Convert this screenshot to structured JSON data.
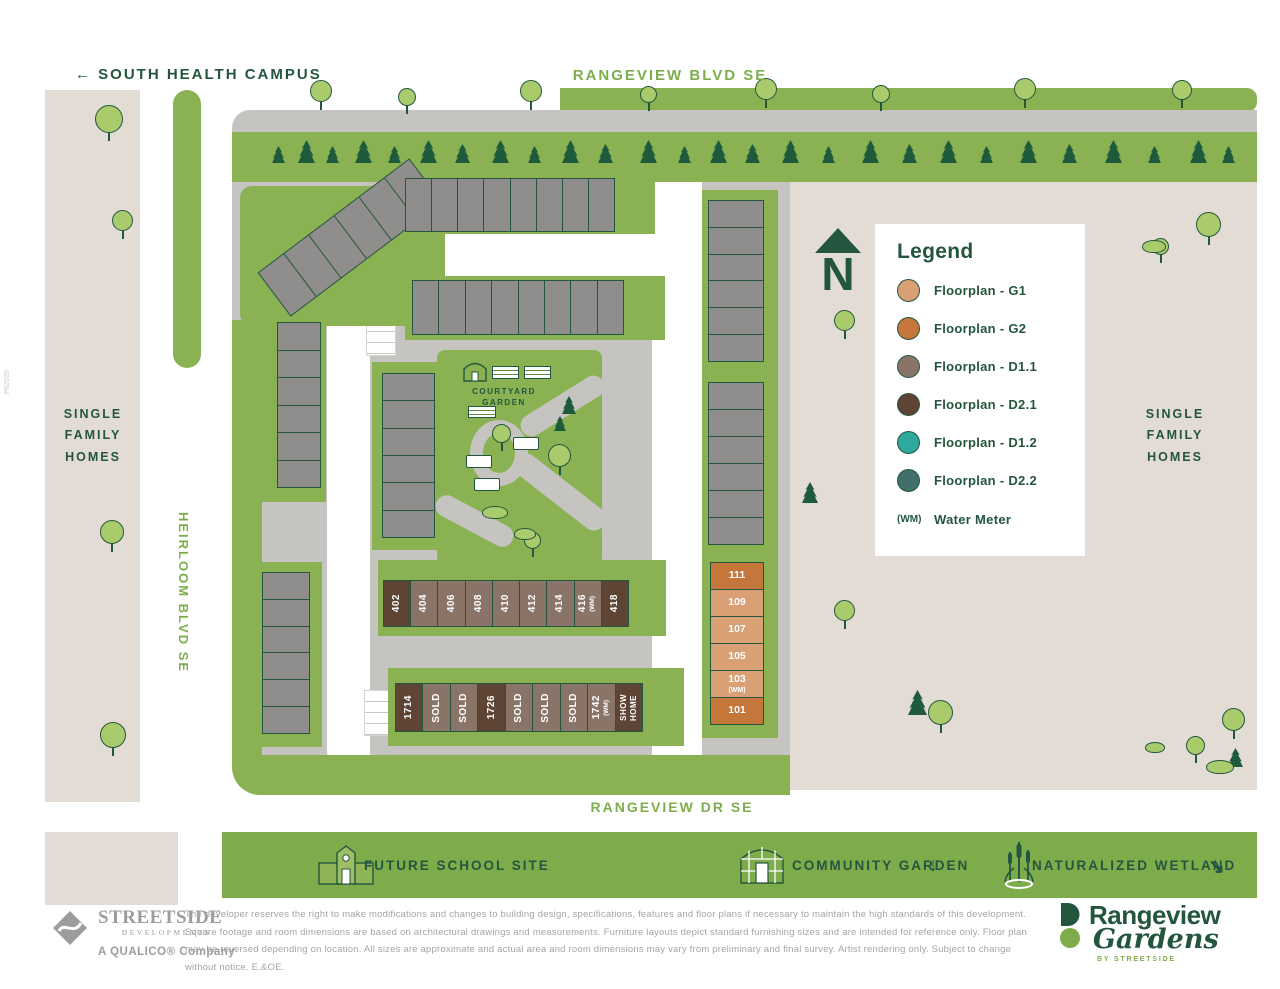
{
  "map": {
    "south_health_campus": "← SOUTH HEALTH CAMPUS",
    "rangeview_blvd": "RANGEVIEW BLVD SE",
    "rangeview_dr": "RANGEVIEW DR SE",
    "heirloom_blvd": "HEIRLOOM BLVD SE",
    "single_family_left": "SINGLE FAMILY HOMES",
    "single_family_right": "SINGLE FAMILY HOMES",
    "north_label": "N",
    "courtyard_line1": "COURTYARD",
    "courtyard_line2": "GARDEN",
    "revision_code": "P62026"
  },
  "legend": {
    "title": "Legend",
    "items": [
      {
        "label": "Floorplan - G1",
        "color": "#D9A075"
      },
      {
        "label": "Floorplan - G2",
        "color": "#C4763B"
      },
      {
        "label": "Floorplan - D1.1",
        "color": "#8A7468"
      },
      {
        "label": "Floorplan - D2.1",
        "color": "#5E4434"
      },
      {
        "label": "Floorplan - D1.2",
        "color": "#2FA89D"
      },
      {
        "label": "Floorplan - D2.2",
        "color": "#41706A"
      }
    ],
    "water_meter_symbol": "(WM)",
    "water_meter_label": "Water Meter"
  },
  "units": {
    "row_400": [
      {
        "label": "402",
        "type": "D2.1"
      },
      {
        "label": "404",
        "type": "D1.1"
      },
      {
        "label": "406",
        "type": "D1.1"
      },
      {
        "label": "408",
        "type": "D1.1"
      },
      {
        "label": "410",
        "type": "D1.1"
      },
      {
        "label": "412",
        "type": "D1.1"
      },
      {
        "label": "414",
        "type": "D1.1"
      },
      {
        "label": "416",
        "sublabel": "(WM)",
        "type": "D1.1"
      },
      {
        "label": "418",
        "type": "D2.1"
      }
    ],
    "row_1700": [
      {
        "label": "1714",
        "type": "D2.1"
      },
      {
        "label": "SOLD",
        "type": "D1.1"
      },
      {
        "label": "SOLD",
        "type": "D1.1"
      },
      {
        "label": "1726",
        "type": "D2.1"
      },
      {
        "label": "SOLD",
        "type": "D1.1"
      },
      {
        "label": "SOLD",
        "type": "D1.1"
      },
      {
        "label": "SOLD",
        "type": "D1.1"
      },
      {
        "label": "1742",
        "sublabel": "(WM)",
        "type": "D1.1"
      },
      {
        "label": "SHOW",
        "label2": "HOME",
        "type": "D2.1"
      }
    ],
    "col_100": [
      {
        "label": "111",
        "type": "G2"
      },
      {
        "label": "109",
        "type": "G1"
      },
      {
        "label": "107",
        "type": "G1"
      },
      {
        "label": "105",
        "type": "G1"
      },
      {
        "label": "103",
        "sublabel": "(WM)",
        "type": "G1"
      },
      {
        "label": "101",
        "type": "G2"
      }
    ]
  },
  "banner": {
    "future_school_site": "FUTURE SCHOOL SITE",
    "community_garden": "COMMUNITY GARDEN",
    "community_garden_arrow": "↓",
    "naturalized_wetland": "NATURALIZED WETLAND",
    "naturalized_wetland_arrow": "↘"
  },
  "footer": {
    "streetside_name": "STREETSIDE",
    "streetside_sub": "DEVELOPMENTS",
    "qualico_line": "A QUALICO® Company",
    "disclaimer": "The developer reserves the right to make modifications and changes to building design, specifications, features and floor plans if necessary to maintain the high standards of this development. Square footage and room dimensions are based on architectural drawings and measurements. Furniture layouts depict standard furnishing sizes and are intended for reference only. Floor plan may be reversed depending on location. All sizes are approximate and actual area and room dimensions may vary from preliminary and final survey. Artist rendering only. Subject to change without notice. E.&OE.",
    "brand_name": "Rangeview",
    "brand_script": "Gardens",
    "brand_tagline": "BY STREETSIDE"
  },
  "colors": {
    "accent_dark_green": "#24563F",
    "street_green": "#7DAE4D",
    "lawn_green": "#8AB252",
    "banner_green": "#7FAC4B",
    "beige": "#E2DCD4",
    "road_gray": "#C6C4C1",
    "building_gray": "#8F8E8C",
    "types": {
      "g1": "#D9A075",
      "g2": "#C4763B",
      "d11": "#8A7468",
      "d21": "#5E4434",
      "d12": "#2FA89D",
      "d22": "#41706A"
    }
  }
}
